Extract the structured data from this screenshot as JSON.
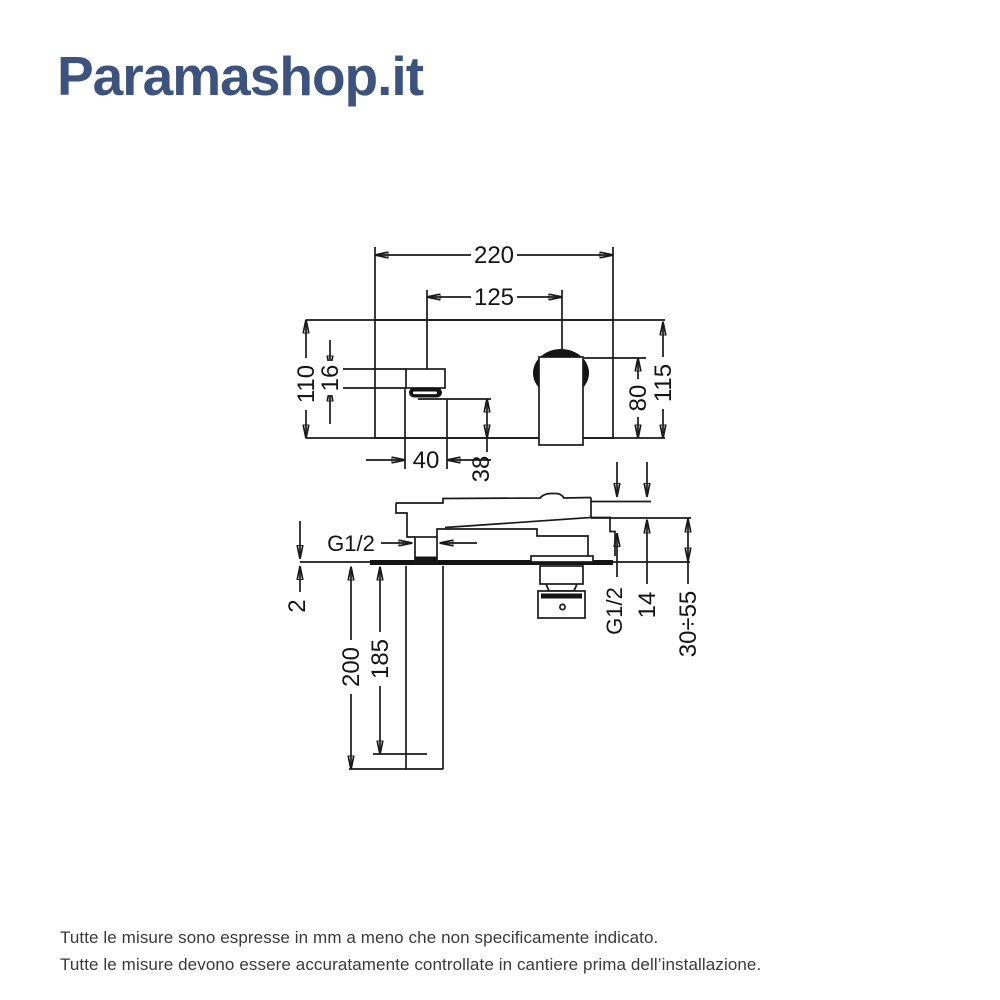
{
  "logo": {
    "text": "Paramashop.it",
    "color": "#3C5380"
  },
  "diagram": {
    "front": {
      "plate_width": "220",
      "spout_to_handle": "125",
      "plate_height": "110",
      "spout_height": "16",
      "spout_width": "40",
      "spout_drop": "38",
      "handle_height": "80",
      "total_height": "115"
    },
    "side": {
      "outlet_thread": "G1/2",
      "plate_thickness": "2",
      "body_depth_total": "200",
      "body_depth_inner": "185",
      "inlet_thread": "G1/2",
      "handle_end_thickness": "14",
      "wall_depth_range": "30÷55"
    },
    "line_color": "#1a1a1a"
  },
  "footer": {
    "line1": "Tutte le misure sono espresse in mm a meno che non specificamente indicato.",
    "line2": "Tutte le misure devono essere accuratamente controllate in cantiere prima dell’installazione."
  }
}
